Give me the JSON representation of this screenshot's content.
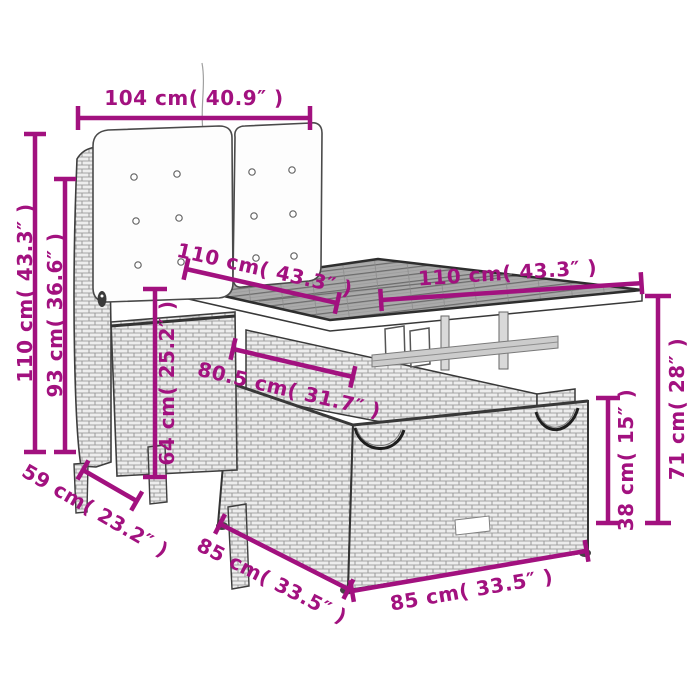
{
  "page": {
    "background": "#ffffff"
  },
  "diagram": {
    "accent_color": "#A2117F",
    "line_art_color": "#383838",
    "dims": {
      "chair_width": "104 cm( 40.9″ )",
      "chair_total_height": "110 cm( 43.3″ )",
      "chair_backrest_height": "93 cm( 36.6″ )",
      "table_top_side_left": "110 cm( 43.3″ )",
      "table_top_side_right": "110 cm( 43.3″ )",
      "table_mid_width": "80.5 cm( 31.7″ )",
      "seat_height": "64 cm( 25.2″ )",
      "table_height": "71 cm( 28″ )",
      "table_base_height": "38 cm( 15″ )",
      "chair_depth": "59 cm( 23.2″ )",
      "base_side_left": "85 cm( 33.5″ )",
      "base_side_right": "85 cm( 33.5″ )"
    }
  }
}
